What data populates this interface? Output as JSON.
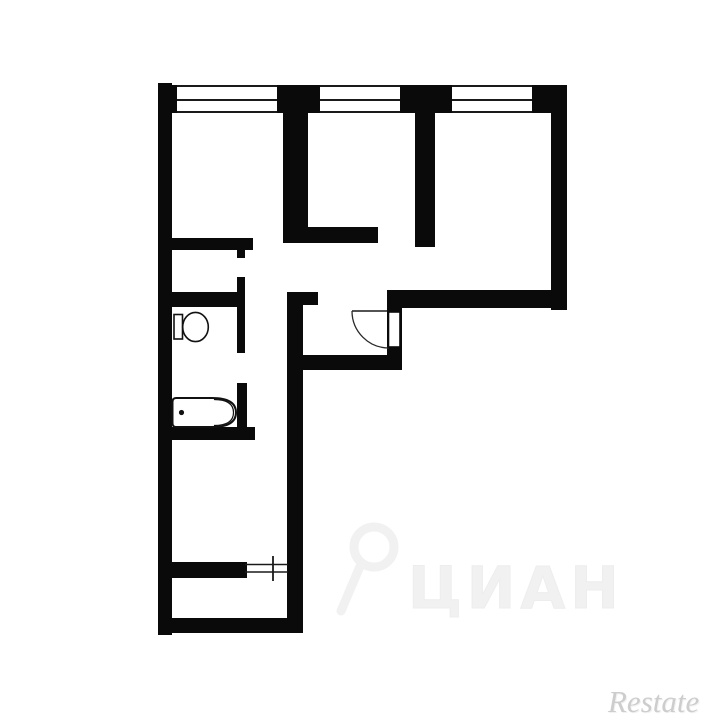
{
  "page": {
    "background": "#ffffff"
  },
  "plan": {
    "kind": "apartment-floor-plan",
    "wall_color": "#0a0a0a",
    "line_color": "#1a1a1a",
    "walls": [
      {
        "name": "outer-wall-left",
        "r": [
          158,
          83,
          14,
          552
        ]
      },
      {
        "name": "top-wall-pier-1",
        "r": [
          158,
          85,
          19,
          28
        ]
      },
      {
        "name": "top-wall-pier-2",
        "r": [
          277,
          85,
          43,
          28
        ]
      },
      {
        "name": "top-wall-pier-3",
        "r": [
          400,
          85,
          52,
          28
        ]
      },
      {
        "name": "top-wall-pier-4",
        "r": [
          532,
          85,
          35,
          28
        ]
      },
      {
        "name": "outer-wall-right",
        "r": [
          551,
          85,
          16,
          225
        ]
      },
      {
        "name": "outer-wall-right-section-bottom",
        "r": [
          387,
          290,
          180,
          18
        ]
      },
      {
        "name": "outer-wall-bottom",
        "r": [
          158,
          618,
          145,
          15
        ]
      },
      {
        "name": "wall-room1-room2",
        "r": [
          283,
          113,
          25,
          130
        ]
      },
      {
        "name": "wall-room2-bottom-arm",
        "r": [
          283,
          227,
          95,
          16
        ]
      },
      {
        "name": "wall-room2-room3",
        "r": [
          415,
          113,
          20,
          134
        ]
      },
      {
        "name": "wall-room1-bottom",
        "r": [
          169,
          238,
          84,
          12
        ]
      },
      {
        "name": "wall-closet-stub",
        "r": [
          237,
          250,
          8,
          8
        ]
      },
      {
        "name": "wall-closet-right",
        "r": [
          237,
          277,
          8,
          76
        ]
      },
      {
        "name": "wall-bathroom-top",
        "r": [
          169,
          292,
          76,
          15
        ]
      },
      {
        "name": "wall-bathroom-right",
        "r": [
          237,
          383,
          10,
          44
        ]
      },
      {
        "name": "wall-bathroom-bottom",
        "r": [
          168,
          427,
          87,
          13
        ]
      },
      {
        "name": "wall-hall-vertical",
        "r": [
          287,
          292,
          16,
          331
        ]
      },
      {
        "name": "wall-hall-vertical-stub",
        "r": [
          303,
          292,
          15,
          13
        ]
      },
      {
        "name": "wall-entry-right",
        "r": [
          387,
          308,
          15,
          62
        ]
      },
      {
        "name": "wall-hall-bottom",
        "r": [
          287,
          355,
          115,
          15
        ]
      },
      {
        "name": "wall-lower-divider",
        "r": [
          170,
          562,
          77,
          16
        ]
      }
    ],
    "windows": {
      "band_y": 85,
      "band_h": 28,
      "line_offsets": [
        0,
        14,
        26
      ],
      "items": [
        {
          "name": "window-1",
          "x": 177,
          "w": 100
        },
        {
          "name": "window-2",
          "x": 320,
          "w": 80
        },
        {
          "name": "window-3",
          "x": 452,
          "w": 80
        }
      ]
    },
    "fixtures": [
      "toilet",
      "bathtub",
      "entry-swing-door",
      "corridor-doorway-symbol"
    ]
  },
  "watermarks": {
    "center": {
      "text": "ЦИАН",
      "color": "#f1f1f1"
    },
    "corner": {
      "text": "Restate",
      "color": "#cdcdcd"
    }
  }
}
